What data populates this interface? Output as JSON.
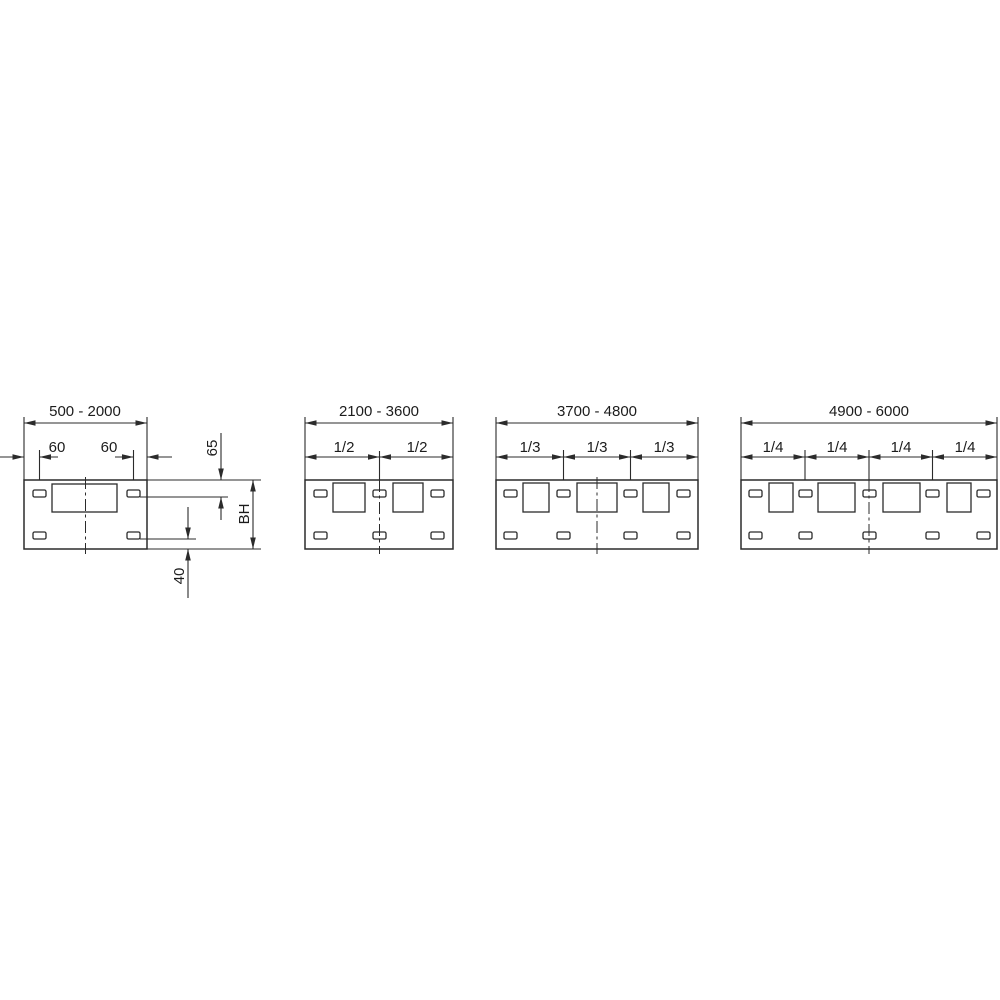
{
  "drawing_title": "Panel width range dimension diagrams",
  "colors": {
    "background": "#ffffff",
    "line": "#2b2b2b"
  },
  "diagrams": [
    {
      "id": "panel-width-500-2000",
      "range_label": "500 - 2000",
      "dims": {
        "left_slot_offset": "60",
        "right_slot_offset": "60",
        "slot_top_offset": "65",
        "panel_height": "BH",
        "slot_bottom_offset": "40"
      },
      "top_slots": 2,
      "bottom_slots": 2,
      "cutouts": 1
    },
    {
      "id": "panel-width-2100-3600",
      "range_label": "2100 - 3600",
      "fractions": [
        "1/2",
        "1/2"
      ],
      "top_slots": 3,
      "bottom_slots": 3,
      "cutouts": 2
    },
    {
      "id": "panel-width-3700-4800",
      "range_label": "3700 - 4800",
      "fractions": [
        "1/3",
        "1/3",
        "1/3"
      ],
      "top_slots": 4,
      "bottom_slots": 4,
      "cutouts": 3
    },
    {
      "id": "panel-width-4900-6000",
      "range_label": "4900 - 6000",
      "fractions": [
        "1/4",
        "1/4",
        "1/4",
        "1/4"
      ],
      "top_slots": 5,
      "bottom_slots": 5,
      "cutouts": 4
    }
  ]
}
